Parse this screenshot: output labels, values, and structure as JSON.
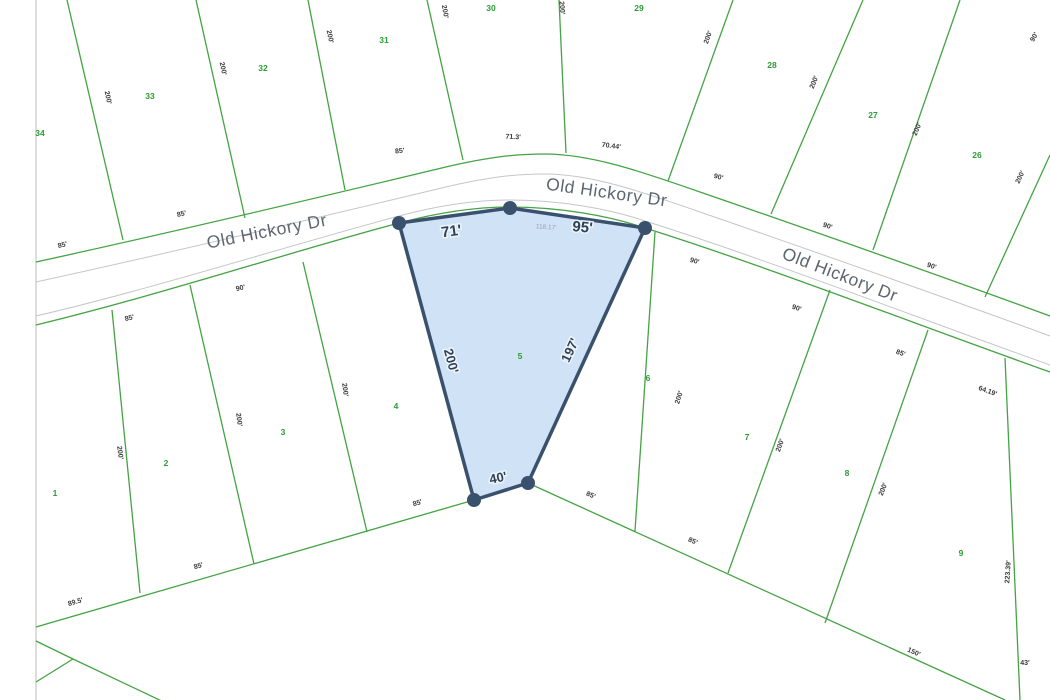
{
  "road": {
    "label": "Old Hickory Dr"
  },
  "highlighted_lot": {
    "number": "5",
    "dimensions": {
      "front_left": "71'",
      "front_right": "95'",
      "front_total": "118.17'",
      "side_left": "200'",
      "side_right": "197'",
      "rear": "40'"
    }
  },
  "lots_above_road": [
    "34",
    "33",
    "32",
    "31",
    "30",
    "29",
    "28",
    "27",
    "26"
  ],
  "lots_below_road": [
    "1",
    "2",
    "3",
    "4",
    "5",
    "6",
    "7",
    "8",
    "9"
  ],
  "colors": {
    "parcel_line": "#44a344",
    "lot_number_text": "#2c9c34",
    "road_line": "#c3c6c8",
    "road_text": "#5d6670",
    "dimension_text": "#3a3a3a",
    "highlight_fill": "#cfe2f6",
    "highlight_stroke": "#3a516e",
    "faint_dimension_text": "#98a4ae"
  },
  "labels": [
    {
      "t": "34",
      "x": 40,
      "y": 136,
      "r": 0,
      "cls": "lot"
    },
    {
      "t": "33",
      "x": 150,
      "y": 99,
      "r": 0,
      "cls": "lot"
    },
    {
      "t": "32",
      "x": 263,
      "y": 71,
      "r": 0,
      "cls": "lot"
    },
    {
      "t": "31",
      "x": 384,
      "y": 43,
      "r": 0,
      "cls": "lot"
    },
    {
      "t": "30",
      "x": 491,
      "y": 11,
      "r": 0,
      "cls": "lot"
    },
    {
      "t": "29",
      "x": 639,
      "y": 11,
      "r": 0,
      "cls": "lot"
    },
    {
      "t": "28",
      "x": 772,
      "y": 68,
      "r": 0,
      "cls": "lot"
    },
    {
      "t": "27",
      "x": 873,
      "y": 118,
      "r": 0,
      "cls": "lot"
    },
    {
      "t": "26",
      "x": 977,
      "y": 158,
      "r": 0,
      "cls": "lot"
    },
    {
      "t": "1",
      "x": 55,
      "y": 496,
      "r": 0,
      "cls": "lot"
    },
    {
      "t": "2",
      "x": 166,
      "y": 466,
      "r": 0,
      "cls": "lot"
    },
    {
      "t": "3",
      "x": 283,
      "y": 435,
      "r": 0,
      "cls": "lot"
    },
    {
      "t": "4",
      "x": 396,
      "y": 409,
      "r": 0,
      "cls": "lot"
    },
    {
      "t": "5",
      "x": 520,
      "y": 359,
      "r": 0,
      "cls": "lot"
    },
    {
      "t": "6",
      "x": 648,
      "y": 381,
      "r": 0,
      "cls": "lot"
    },
    {
      "t": "7",
      "x": 747,
      "y": 440,
      "r": 0,
      "cls": "lot"
    },
    {
      "t": "8",
      "x": 847,
      "y": 476,
      "r": 0,
      "cls": "lot"
    },
    {
      "t": "9",
      "x": 961,
      "y": 556,
      "r": 0,
      "cls": "lot"
    },
    {
      "t": "71'",
      "x": 452,
      "y": 236,
      "r": -8,
      "cls": "big"
    },
    {
      "t": "95'",
      "x": 582,
      "y": 232,
      "r": 6,
      "cls": "big"
    },
    {
      "t": "118.17'",
      "x": 546,
      "y": 229,
      "r": 4,
      "cls": "faint"
    },
    {
      "t": "200'",
      "x": 447,
      "y": 362,
      "r": 75,
      "cls": "mid"
    },
    {
      "t": "197'",
      "x": 574,
      "y": 352,
      "r": -65,
      "cls": "mid"
    },
    {
      "t": "40'",
      "x": 499,
      "y": 482,
      "r": -12,
      "cls": "mid"
    },
    {
      "t": "85'",
      "x": 63,
      "y": 247,
      "r": -14,
      "cls": "dim"
    },
    {
      "t": "85'",
      "x": 182,
      "y": 216,
      "r": -12,
      "cls": "dim"
    },
    {
      "t": "85'",
      "x": 400,
      "y": 153,
      "r": -6,
      "cls": "dim"
    },
    {
      "t": "71.3'",
      "x": 513,
      "y": 139,
      "r": 3,
      "cls": "dim"
    },
    {
      "t": "70.44'",
      "x": 611,
      "y": 148,
      "r": 7,
      "cls": "dim"
    },
    {
      "t": "90'",
      "x": 718,
      "y": 179,
      "r": 15,
      "cls": "dim"
    },
    {
      "t": "90'",
      "x": 827,
      "y": 228,
      "r": 18,
      "cls": "dim"
    },
    {
      "t": "90'",
      "x": 931,
      "y": 268,
      "r": 19,
      "cls": "dim"
    },
    {
      "t": "90'",
      "x": 1036,
      "y": 38,
      "r": -60,
      "cls": "dim"
    },
    {
      "t": "200'",
      "x": 106,
      "y": 98,
      "r": 78,
      "cls": "dim"
    },
    {
      "t": "200'",
      "x": 221,
      "y": 69,
      "r": 78,
      "cls": "dim"
    },
    {
      "t": "200'",
      "x": 328,
      "y": 37,
      "r": 78,
      "cls": "dim"
    },
    {
      "t": "200'",
      "x": 443,
      "y": 12,
      "r": 80,
      "cls": "dim"
    },
    {
      "t": "200'",
      "x": 560,
      "y": 8,
      "r": 85,
      "cls": "dim"
    },
    {
      "t": "200'",
      "x": 710,
      "y": 38,
      "r": -70,
      "cls": "dim"
    },
    {
      "t": "200'",
      "x": 816,
      "y": 83,
      "r": -68,
      "cls": "dim"
    },
    {
      "t": "200'",
      "x": 919,
      "y": 130,
      "r": -66,
      "cls": "dim"
    },
    {
      "t": "200'",
      "x": 1022,
      "y": 178,
      "r": -64,
      "cls": "dim"
    },
    {
      "t": "85'",
      "x": 130,
      "y": 320,
      "r": -14,
      "cls": "dim"
    },
    {
      "t": "90'",
      "x": 241,
      "y": 290,
      "r": -13,
      "cls": "dim"
    },
    {
      "t": "90'",
      "x": 694,
      "y": 263,
      "r": 16,
      "cls": "dim"
    },
    {
      "t": "90'",
      "x": 796,
      "y": 310,
      "r": 18,
      "cls": "dim"
    },
    {
      "t": "85'",
      "x": 900,
      "y": 355,
      "r": 19,
      "cls": "dim"
    },
    {
      "t": "64.19'",
      "x": 987,
      "y": 393,
      "r": 20,
      "cls": "dim"
    },
    {
      "t": "200'",
      "x": 118,
      "y": 453,
      "r": 82,
      "cls": "dim"
    },
    {
      "t": "200'",
      "x": 237,
      "y": 420,
      "r": 82,
      "cls": "dim"
    },
    {
      "t": "200'",
      "x": 343,
      "y": 390,
      "r": 82,
      "cls": "dim"
    },
    {
      "t": "200'",
      "x": 681,
      "y": 398,
      "r": -72,
      "cls": "dim"
    },
    {
      "t": "200'",
      "x": 782,
      "y": 446,
      "r": -70,
      "cls": "dim"
    },
    {
      "t": "200'",
      "x": 885,
      "y": 490,
      "r": -68,
      "cls": "dim"
    },
    {
      "t": "89.5'",
      "x": 76,
      "y": 604,
      "r": -16,
      "cls": "dim"
    },
    {
      "t": "85'",
      "x": 199,
      "y": 568,
      "r": -16,
      "cls": "dim"
    },
    {
      "t": "85'",
      "x": 418,
      "y": 505,
      "r": -16,
      "cls": "dim"
    },
    {
      "t": "85'",
      "x": 590,
      "y": 497,
      "r": 24,
      "cls": "dim"
    },
    {
      "t": "85'",
      "x": 692,
      "y": 543,
      "r": 24,
      "cls": "dim"
    },
    {
      "t": "150'",
      "x": 913,
      "y": 654,
      "r": 24,
      "cls": "dim"
    },
    {
      "t": "223.39'",
      "x": 1010,
      "y": 572,
      "r": -86,
      "cls": "dim"
    },
    {
      "t": "43'",
      "x": 1025,
      "y": 665,
      "r": 0,
      "cls": "dim"
    }
  ]
}
